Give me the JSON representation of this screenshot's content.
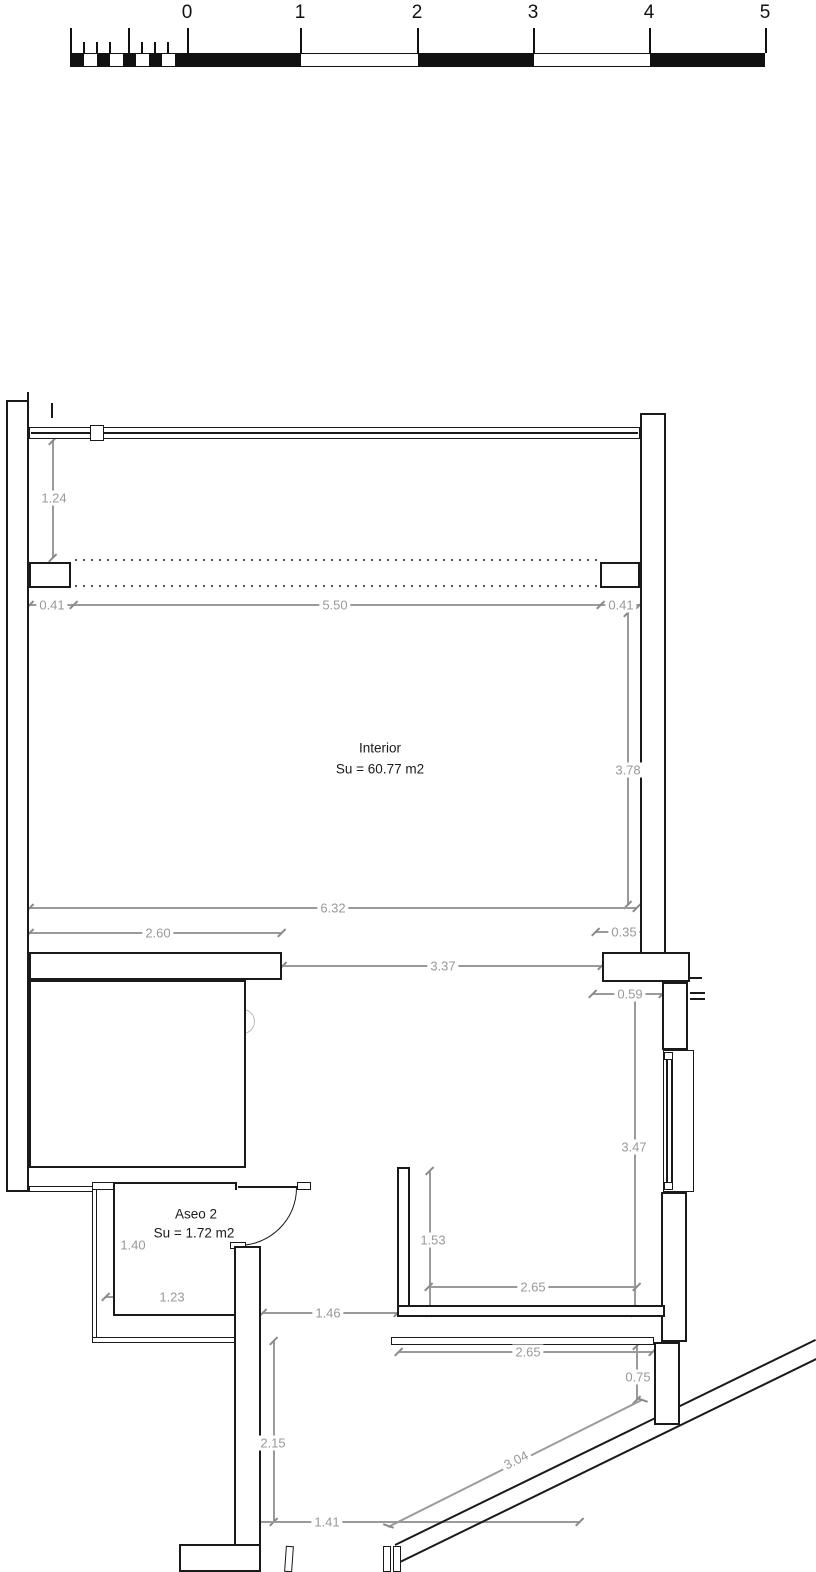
{
  "drawing": {
    "type": "floor-plan",
    "colors": {
      "wall": "#1a1a1a",
      "dimension": "#999999",
      "stair_detail": "#cccccc"
    }
  },
  "scale_bar": {
    "labels": [
      "0",
      "1",
      "2",
      "3",
      "4",
      "5"
    ]
  },
  "rooms": {
    "interior": {
      "name": "Interior",
      "area": "Su = 60.77 m2"
    },
    "aseo": {
      "name": "Aseo 2",
      "area": "Su = 1.72 m2"
    }
  },
  "dims": {
    "left_height": "1.24",
    "top_left_offset": "0.41",
    "top_width": "5.50",
    "top_right_offset": "0.41",
    "interior_height": "3.78",
    "interior_width": "6.32",
    "stair_width": "2.60",
    "right_jog": "0.35",
    "hall_width": "3.37",
    "hall_right_width": "0.59",
    "right_lower_height": "3.47",
    "terrace_inner_height": "1.53",
    "terrace_inner_width": "2.65",
    "aseo_height": "1.40",
    "aseo_width": "1.23",
    "passage_width": "1.46",
    "terrace_outer_width": "2.65",
    "ramp_drop": "0.75",
    "passage_height": "2.15",
    "exit_width": "1.41",
    "ramp_length": "3.04"
  }
}
